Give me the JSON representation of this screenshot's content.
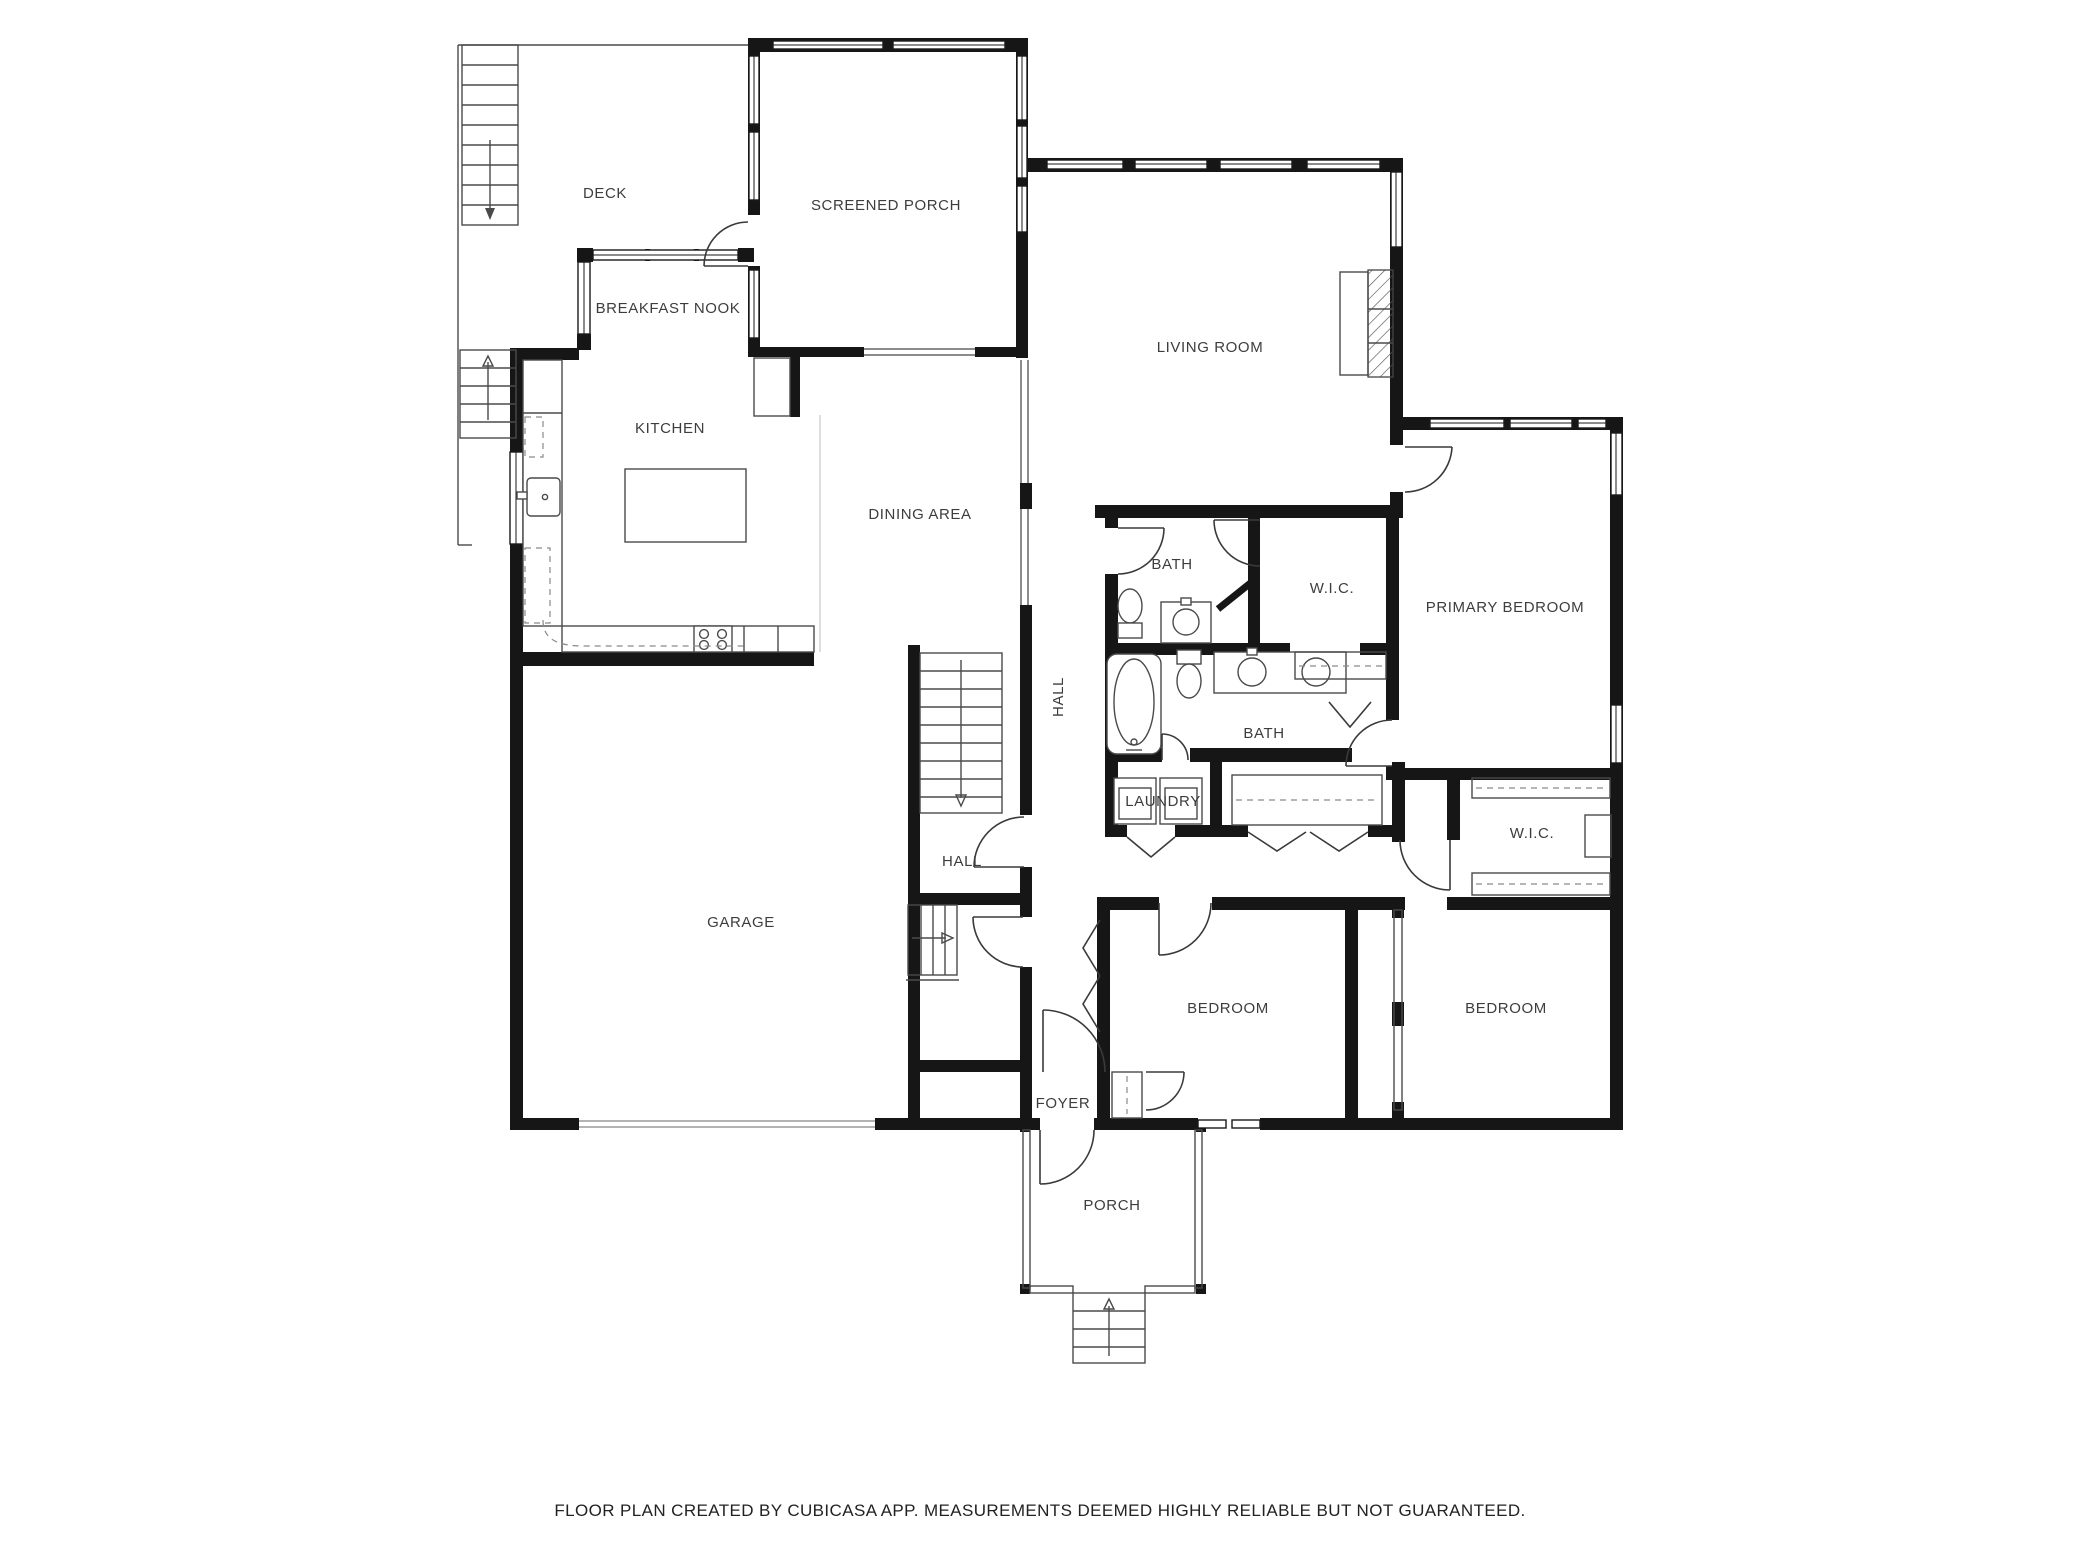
{
  "rooms": {
    "deck": {
      "label": "DECK"
    },
    "screened_porch": {
      "label": "SCREENED PORCH"
    },
    "breakfast_nook": {
      "label": "BREAKFAST NOOK"
    },
    "kitchen": {
      "label": "KITCHEN"
    },
    "living_room": {
      "label": "LIVING ROOM"
    },
    "dining_area": {
      "label": "DINING AREA"
    },
    "bath_upper": {
      "label": "BATH"
    },
    "wic_upper": {
      "label": "W.I.C."
    },
    "primary_bedroom": {
      "label": "PRIMARY BEDROOM"
    },
    "hall_corridor": {
      "label": "HALL"
    },
    "bath_lower": {
      "label": "BATH"
    },
    "laundry": {
      "label": "LAUNDRY"
    },
    "wic_lower": {
      "label": "W.I.C."
    },
    "hall_stairs": {
      "label": "HALL"
    },
    "garage": {
      "label": "GARAGE"
    },
    "bedroom_left": {
      "label": "BEDROOM"
    },
    "bedroom_right": {
      "label": "BEDROOM"
    },
    "foyer": {
      "label": "FOYER"
    },
    "porch": {
      "label": "PORCH"
    }
  },
  "footer": {
    "text": "FLOOR PLAN CREATED BY CUBICASA APP. MEASUREMENTS DEEMED HIGHLY RELIABLE BUT NOT GUARANTEED."
  },
  "colors": {
    "wall": "#161616",
    "label": "#3d3d3d",
    "background": "#ffffff"
  }
}
